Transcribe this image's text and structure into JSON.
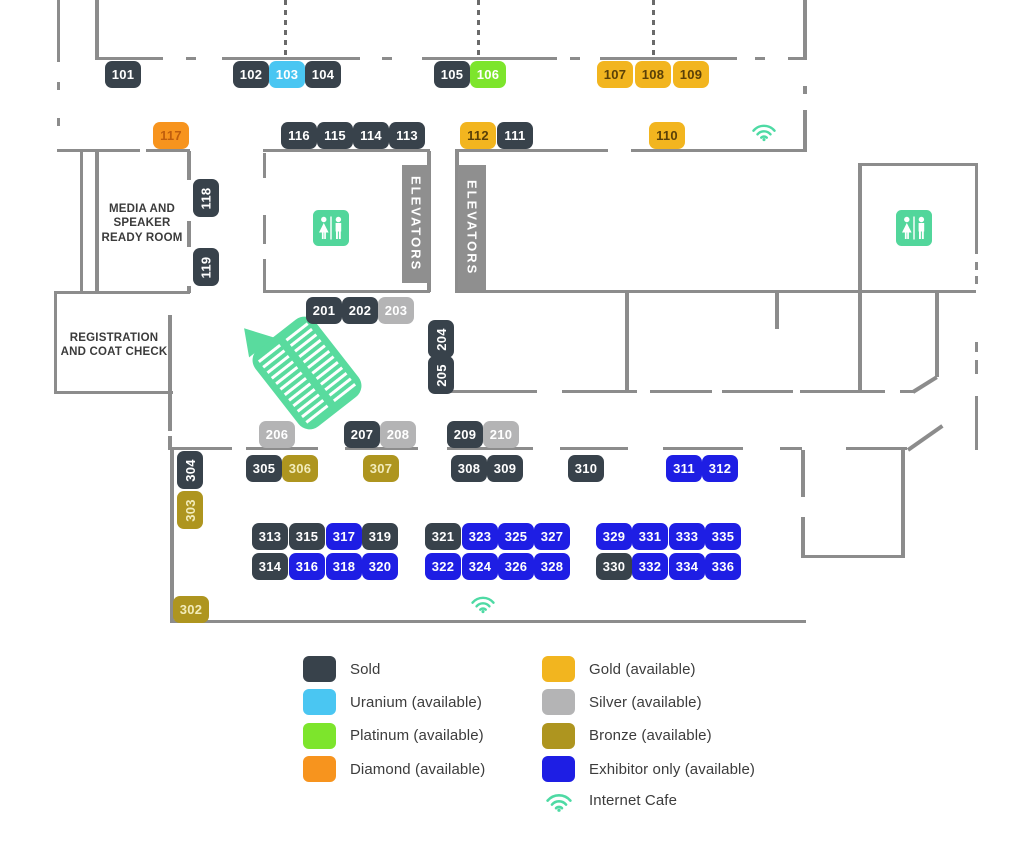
{
  "colors": {
    "wall": "#8C8C8C",
    "elevator_bar": "#8F8F8F",
    "room_text": "#3B3B3B",
    "legend_text": "#3C3C3C",
    "wifi_green": "#4EDAA4",
    "restroom_green": "#52D69B",
    "escalator_green": "#59DB9E",
    "tiers": {
      "sold": {
        "bg": "#38424B",
        "text": "#FFFFFF"
      },
      "uranium": {
        "bg": "#4AC6F2",
        "text": "#FFFFFF"
      },
      "platinum": {
        "bg": "#7DE52C",
        "text": "#FFFFFF"
      },
      "diamond": {
        "bg": "#F7941E",
        "text": "#BF5E0E"
      },
      "gold": {
        "bg": "#F2B51F",
        "text": "#5A4008"
      },
      "silver": {
        "bg": "#B4B4B5",
        "text": "#FFFFFF"
      },
      "bronze": {
        "bg": "#AE951F",
        "text": "#F2ECBB"
      },
      "exhibitor": {
        "bg": "#1E1EE4",
        "text": "#FFFFFF"
      }
    }
  },
  "rooms": {
    "media": [
      "MEDIA AND",
      "SPEAKER",
      "READY ROOM"
    ],
    "registration": [
      "REGISTRATION",
      "AND COAT CHECK"
    ],
    "elevators": "ELEVATORS"
  },
  "booths": [
    {
      "n": "101",
      "tier": "sold",
      "x": 105,
      "y": 61
    },
    {
      "n": "102",
      "tier": "sold",
      "x": 233,
      "y": 61
    },
    {
      "n": "103",
      "tier": "uranium",
      "x": 269,
      "y": 61
    },
    {
      "n": "104",
      "tier": "sold",
      "x": 305,
      "y": 61
    },
    {
      "n": "105",
      "tier": "sold",
      "x": 434,
      "y": 61
    },
    {
      "n": "106",
      "tier": "platinum",
      "x": 470,
      "y": 61
    },
    {
      "n": "107",
      "tier": "gold",
      "x": 597,
      "y": 61
    },
    {
      "n": "108",
      "tier": "gold",
      "x": 635,
      "y": 61
    },
    {
      "n": "109",
      "tier": "gold",
      "x": 673,
      "y": 61
    },
    {
      "n": "117",
      "tier": "diamond",
      "x": 153,
      "y": 122
    },
    {
      "n": "116",
      "tier": "sold",
      "x": 281,
      "y": 122
    },
    {
      "n": "115",
      "tier": "sold",
      "x": 317,
      "y": 122
    },
    {
      "n": "114",
      "tier": "sold",
      "x": 353,
      "y": 122
    },
    {
      "n": "113",
      "tier": "sold",
      "x": 389,
      "y": 122
    },
    {
      "n": "112",
      "tier": "gold",
      "x": 460,
      "y": 122
    },
    {
      "n": "111",
      "tier": "sold",
      "x": 497,
      "y": 122
    },
    {
      "n": "110",
      "tier": "gold",
      "x": 649,
      "y": 122
    },
    {
      "n": "118",
      "tier": "sold",
      "x": 193,
      "y": 179,
      "v": true
    },
    {
      "n": "119",
      "tier": "sold",
      "x": 193,
      "y": 248,
      "v": true
    },
    {
      "n": "201",
      "tier": "sold",
      "x": 306,
      "y": 297
    },
    {
      "n": "202",
      "tier": "sold",
      "x": 342,
      "y": 297
    },
    {
      "n": "203",
      "tier": "silver",
      "x": 378,
      "y": 297
    },
    {
      "n": "204",
      "tier": "sold",
      "x": 428,
      "y": 320,
      "v": true
    },
    {
      "n": "205",
      "tier": "sold",
      "x": 428,
      "y": 356,
      "v": true
    },
    {
      "n": "206",
      "tier": "silver",
      "x": 259,
      "y": 421
    },
    {
      "n": "207",
      "tier": "sold",
      "x": 344,
      "y": 421
    },
    {
      "n": "208",
      "tier": "silver",
      "x": 380,
      "y": 421
    },
    {
      "n": "209",
      "tier": "sold",
      "x": 447,
      "y": 421
    },
    {
      "n": "210",
      "tier": "silver",
      "x": 483,
      "y": 421
    },
    {
      "n": "304",
      "tier": "sold",
      "x": 177,
      "y": 451,
      "v": true
    },
    {
      "n": "303",
      "tier": "bronze",
      "x": 177,
      "y": 491,
      "v": true
    },
    {
      "n": "305",
      "tier": "sold",
      "x": 246,
      "y": 455
    },
    {
      "n": "306",
      "tier": "bronze",
      "x": 282,
      "y": 455
    },
    {
      "n": "307",
      "tier": "bronze",
      "x": 363,
      "y": 455
    },
    {
      "n": "308",
      "tier": "sold",
      "x": 451,
      "y": 455
    },
    {
      "n": "309",
      "tier": "sold",
      "x": 487,
      "y": 455
    },
    {
      "n": "310",
      "tier": "sold",
      "x": 568,
      "y": 455
    },
    {
      "n": "311",
      "tier": "exhibitor",
      "x": 666,
      "y": 455
    },
    {
      "n": "312",
      "tier": "exhibitor",
      "x": 702,
      "y": 455
    },
    {
      "n": "313",
      "tier": "sold",
      "x": 252,
      "y": 523
    },
    {
      "n": "315",
      "tier": "sold",
      "x": 289,
      "y": 523
    },
    {
      "n": "317",
      "tier": "exhibitor",
      "x": 326,
      "y": 523
    },
    {
      "n": "319",
      "tier": "sold",
      "x": 362,
      "y": 523
    },
    {
      "n": "321",
      "tier": "sold",
      "x": 425,
      "y": 523
    },
    {
      "n": "323",
      "tier": "exhibitor",
      "x": 462,
      "y": 523
    },
    {
      "n": "325",
      "tier": "exhibitor",
      "x": 498,
      "y": 523
    },
    {
      "n": "327",
      "tier": "exhibitor",
      "x": 534,
      "y": 523
    },
    {
      "n": "329",
      "tier": "exhibitor",
      "x": 596,
      "y": 523
    },
    {
      "n": "331",
      "tier": "exhibitor",
      "x": 632,
      "y": 523
    },
    {
      "n": "333",
      "tier": "exhibitor",
      "x": 669,
      "y": 523
    },
    {
      "n": "335",
      "tier": "exhibitor",
      "x": 705,
      "y": 523
    },
    {
      "n": "314",
      "tier": "sold",
      "x": 252,
      "y": 553
    },
    {
      "n": "316",
      "tier": "exhibitor",
      "x": 289,
      "y": 553
    },
    {
      "n": "318",
      "tier": "exhibitor",
      "x": 326,
      "y": 553
    },
    {
      "n": "320",
      "tier": "exhibitor",
      "x": 362,
      "y": 553
    },
    {
      "n": "322",
      "tier": "exhibitor",
      "x": 425,
      "y": 553
    },
    {
      "n": "324",
      "tier": "exhibitor",
      "x": 462,
      "y": 553
    },
    {
      "n": "326",
      "tier": "exhibitor",
      "x": 498,
      "y": 553
    },
    {
      "n": "328",
      "tier": "exhibitor",
      "x": 534,
      "y": 553
    },
    {
      "n": "330",
      "tier": "sold",
      "x": 596,
      "y": 553
    },
    {
      "n": "332",
      "tier": "exhibitor",
      "x": 632,
      "y": 553
    },
    {
      "n": "334",
      "tier": "exhibitor",
      "x": 669,
      "y": 553
    },
    {
      "n": "336",
      "tier": "exhibitor",
      "x": 705,
      "y": 553
    },
    {
      "n": "302",
      "tier": "bronze",
      "x": 173,
      "y": 596
    }
  ],
  "legend": {
    "columns": [
      [
        {
          "label": "Sold",
          "tier": "sold"
        },
        {
          "label": "Uranium (available)",
          "tier": "uranium"
        },
        {
          "label": "Platinum (available)",
          "tier": "platinum"
        },
        {
          "label": "Diamond (available)",
          "tier": "diamond"
        }
      ],
      [
        {
          "label": "Gold (available)",
          "tier": "gold"
        },
        {
          "label": "Silver (available)",
          "tier": "silver"
        },
        {
          "label": "Bronze (available)",
          "tier": "bronze"
        },
        {
          "label": "Exhibitor only (available)",
          "tier": "exhibitor"
        }
      ]
    ],
    "internet_cafe_label": "Internet Cafe"
  },
  "icons": {
    "wifi": "internet-cafe-wifi",
    "restroom": "restroom",
    "escalator": "escalator"
  }
}
